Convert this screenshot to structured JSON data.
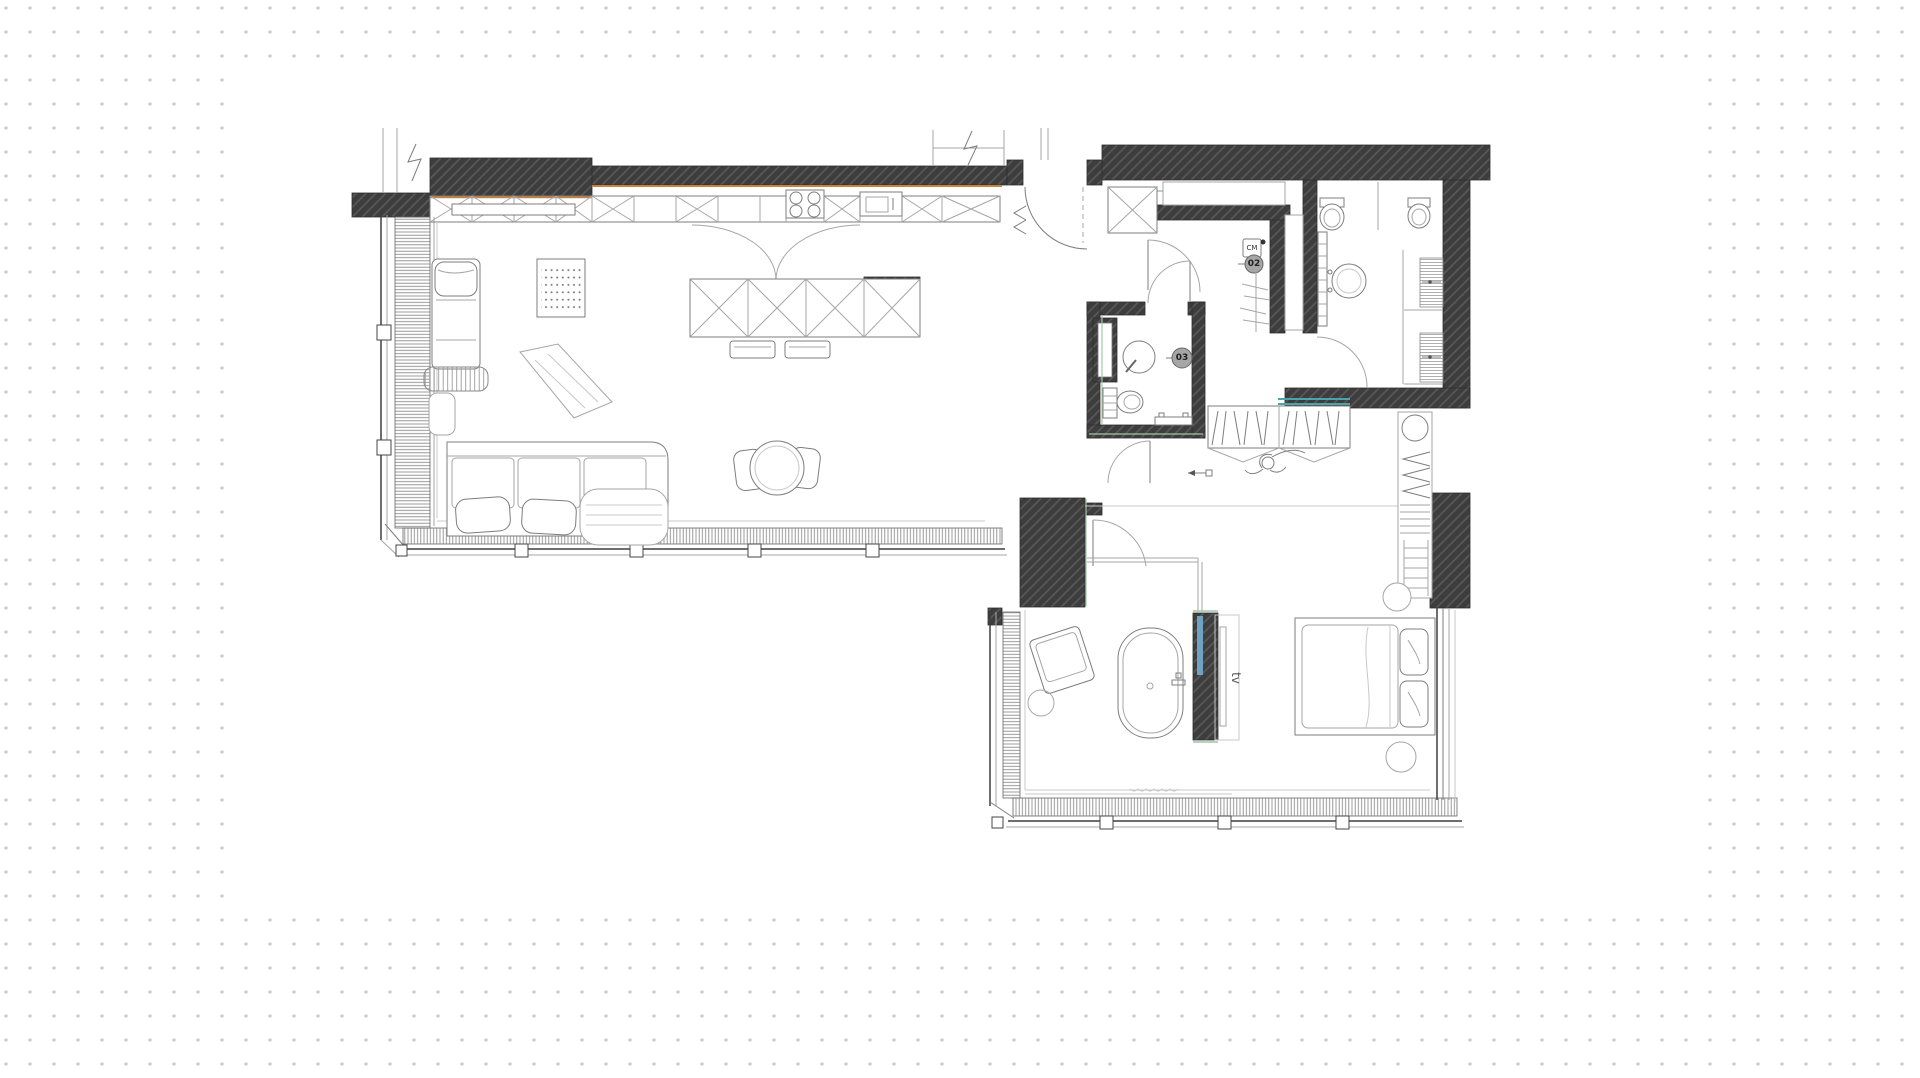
{
  "canvas": {
    "background_color": "#ffffff",
    "dot_color": "#c8c8c8",
    "dot_spacing_px": 24,
    "sheet_color": "#ffffff"
  },
  "plan": {
    "title": "apartment-floor-plan",
    "labels": {
      "closet_badge": "02",
      "bathroom_badge": "03",
      "washing_machine": "CM",
      "tv": "tv"
    },
    "colors": {
      "wall": "#3d3d3d",
      "wall_hatch": "#5a5a5a",
      "line_mid": "#7d7d7d",
      "line_light": "#a6a6a6",
      "accent_orange": "#c9823f",
      "accent_blue": "#6fa3c4",
      "accent_teal": "#4aa3ad",
      "accent_green": "#a3c4a3",
      "badge_fill": "#a6a6a6",
      "badge_text": "#1e1e1e"
    },
    "rooms": [
      {
        "id": "living-kitchen",
        "features": [
          "kitchen-cabinets",
          "cooktop",
          "sink",
          "kitchen-island",
          "bar-stools",
          "double-door",
          "sofa",
          "lounge-chair",
          "striped-ottoman",
          "leaning-mirror",
          "peg-panel",
          "dining-table",
          "dining-chairs",
          "window-wall"
        ]
      },
      {
        "id": "entry-hall",
        "features": [
          "entry-door",
          "shoe-cabinet"
        ]
      },
      {
        "id": "closet-02",
        "features": [
          "washing-machine",
          "hanging-rail",
          "niche",
          "tall-cabinet"
        ]
      },
      {
        "id": "bathroom-main",
        "features": [
          "toilet",
          "bidet",
          "round-basin",
          "towel-ladder",
          "shower-mats"
        ]
      },
      {
        "id": "bathroom-03",
        "features": [
          "round-basin",
          "toilet",
          "shower-niche",
          "bench"
        ]
      },
      {
        "id": "dressing",
        "features": [
          "hanging-wardrobe",
          "figure-sketch",
          "shelf-tower",
          "ladder"
        ]
      },
      {
        "id": "bedroom",
        "features": [
          "bed",
          "pillows",
          "round-nightstands",
          "tv-wall",
          "freestanding-bathtub",
          "armchair",
          "glass-partition",
          "window-walls"
        ]
      }
    ]
  }
}
